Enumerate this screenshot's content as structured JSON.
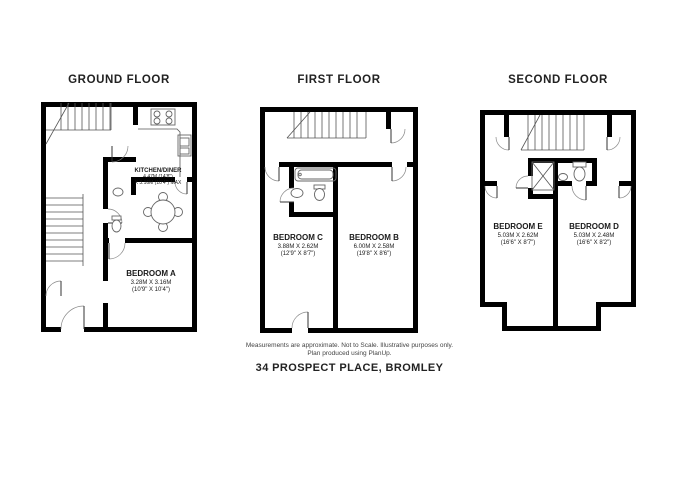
{
  "page": {
    "background": "#ffffff",
    "wall_color": "#000000",
    "line_color": "#666666"
  },
  "footer": {
    "note_line1": "Measurements are approximate. Not to Scale. Illustrative purposes only.",
    "note_line2": "Plan produced using PlanUp.",
    "address": "34 PROSPECT PLACE, BROMLEY"
  },
  "floors": [
    {
      "title": "GROUND FLOOR",
      "rooms": [
        {
          "name": "KITCHEN/DINER",
          "dim1": "4.47M (14'8\")",
          "dim2": "X 3.16M (10'4\") MAX"
        },
        {
          "name": "BEDROOM A",
          "dim1": "3.28M X 3.16M",
          "dim2": "(10'9\" X 10'4\")"
        }
      ]
    },
    {
      "title": "FIRST FLOOR",
      "rooms": [
        {
          "name": "BEDROOM C",
          "dim1": "3.88M X 2.62M",
          "dim2": "(12'9\" X 8'7\")"
        },
        {
          "name": "BEDROOM B",
          "dim1": "6.00M X 2.58M",
          "dim2": "(19'8\" X 8'6\")"
        }
      ]
    },
    {
      "title": "SECOND FLOOR",
      "rooms": [
        {
          "name": "BEDROOM E",
          "dim1": "5.03M X 2.62M",
          "dim2": "(16'6\" X 8'7\")"
        },
        {
          "name": "BEDROOM D",
          "dim1": "5.03M X 2.48M",
          "dim2": "(16'6\" X 8'2\")"
        }
      ]
    }
  ]
}
